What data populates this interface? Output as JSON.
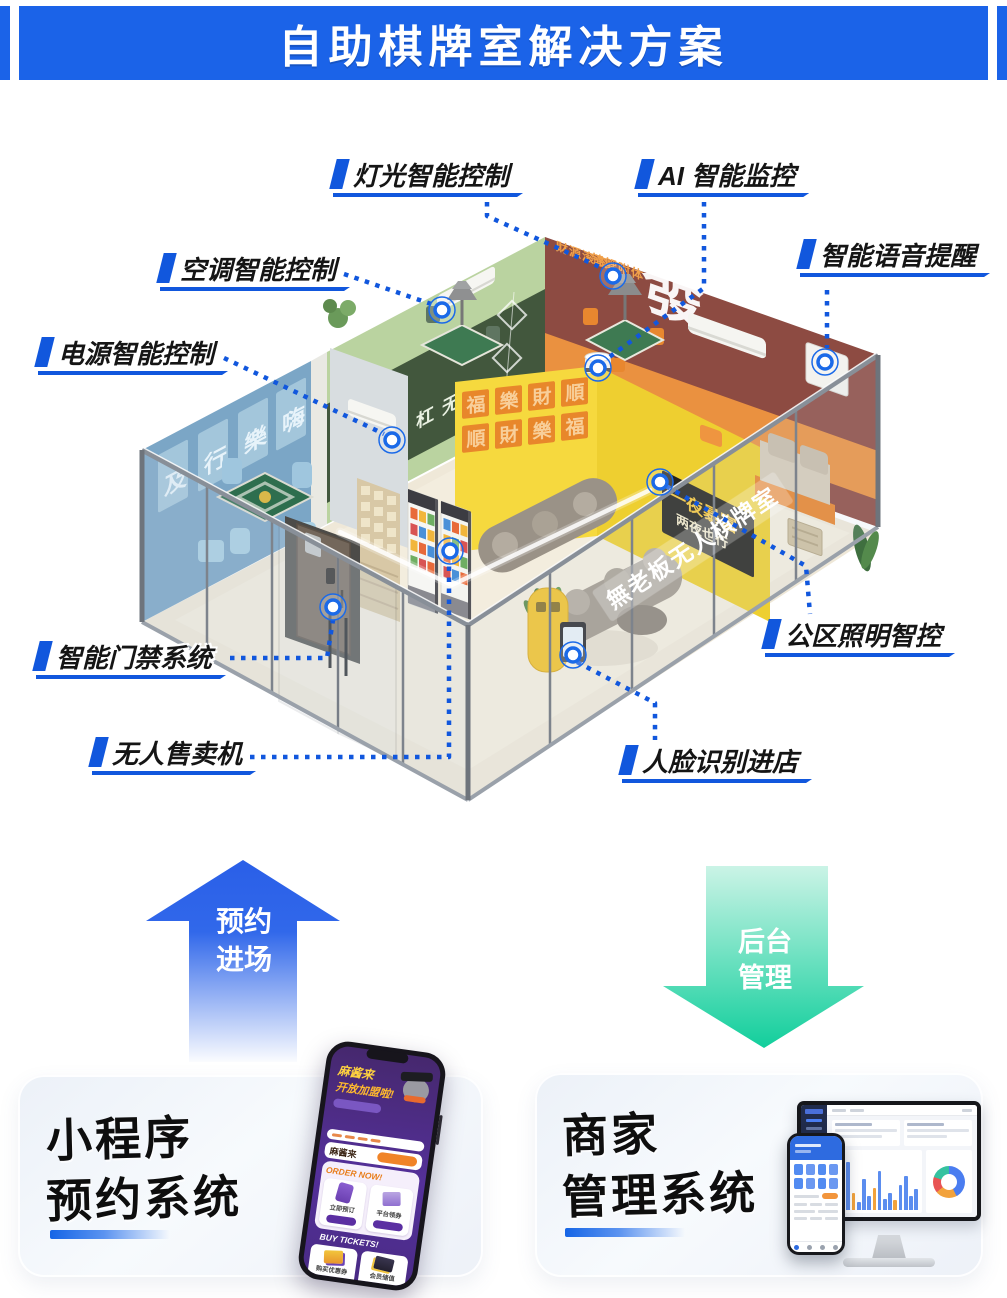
{
  "header": {
    "title": "自助棋牌室解决方案"
  },
  "callouts": [
    {
      "id": "light",
      "label": "灯光智能控制"
    },
    {
      "id": "ai",
      "label": "AI 智能监控"
    },
    {
      "id": "ac",
      "label": "空调智能控制"
    },
    {
      "id": "voice",
      "label": "智能语音提醒"
    },
    {
      "id": "power",
      "label": "电源智能控制"
    },
    {
      "id": "door",
      "label": "智能门禁系统"
    },
    {
      "id": "vending",
      "label": "无人售卖机"
    },
    {
      "id": "publight",
      "label": "公区照明智控"
    },
    {
      "id": "face",
      "label": "人脸识别进店"
    }
  ],
  "flow_up": {
    "line1": "预约",
    "line2": "进场"
  },
  "flow_down": {
    "line1": "后台",
    "line2": "管理"
  },
  "cards": {
    "left": {
      "title_line1": "小程序",
      "title_line2": "预约系统"
    },
    "right": {
      "title_line1": "商家",
      "title_line2": "管理系统"
    }
  },
  "phone_app": {
    "banner_title": "麻酱来",
    "banner_subtitle": "开放加盟啦!",
    "brand": "麻酱来",
    "section1_title": "ORDER NOW!",
    "item1a": "立即预订",
    "item1b": "平台领券",
    "section2_title": "BUY TICKETS!",
    "item2a": "购买优惠券",
    "item2b": "会员储值"
  },
  "room": {
    "glass_sign": "無老板无人棋牌室",
    "wall_char": "發",
    "maroon_text1": "财源滚滚",
    "maroon_text2": "锦鲤附体",
    "board_line1": "一夜暴富",
    "board_line2": "两夜也行",
    "green_wall": "吃搓碰杠无",
    "blue_wall": [
      "及",
      "行",
      "樂",
      "嗨"
    ],
    "posters": [
      "福",
      "樂",
      "財",
      "順"
    ]
  },
  "colors": {
    "accent_blue": "#1b63e8",
    "flow_green": "#0fce9b"
  }
}
